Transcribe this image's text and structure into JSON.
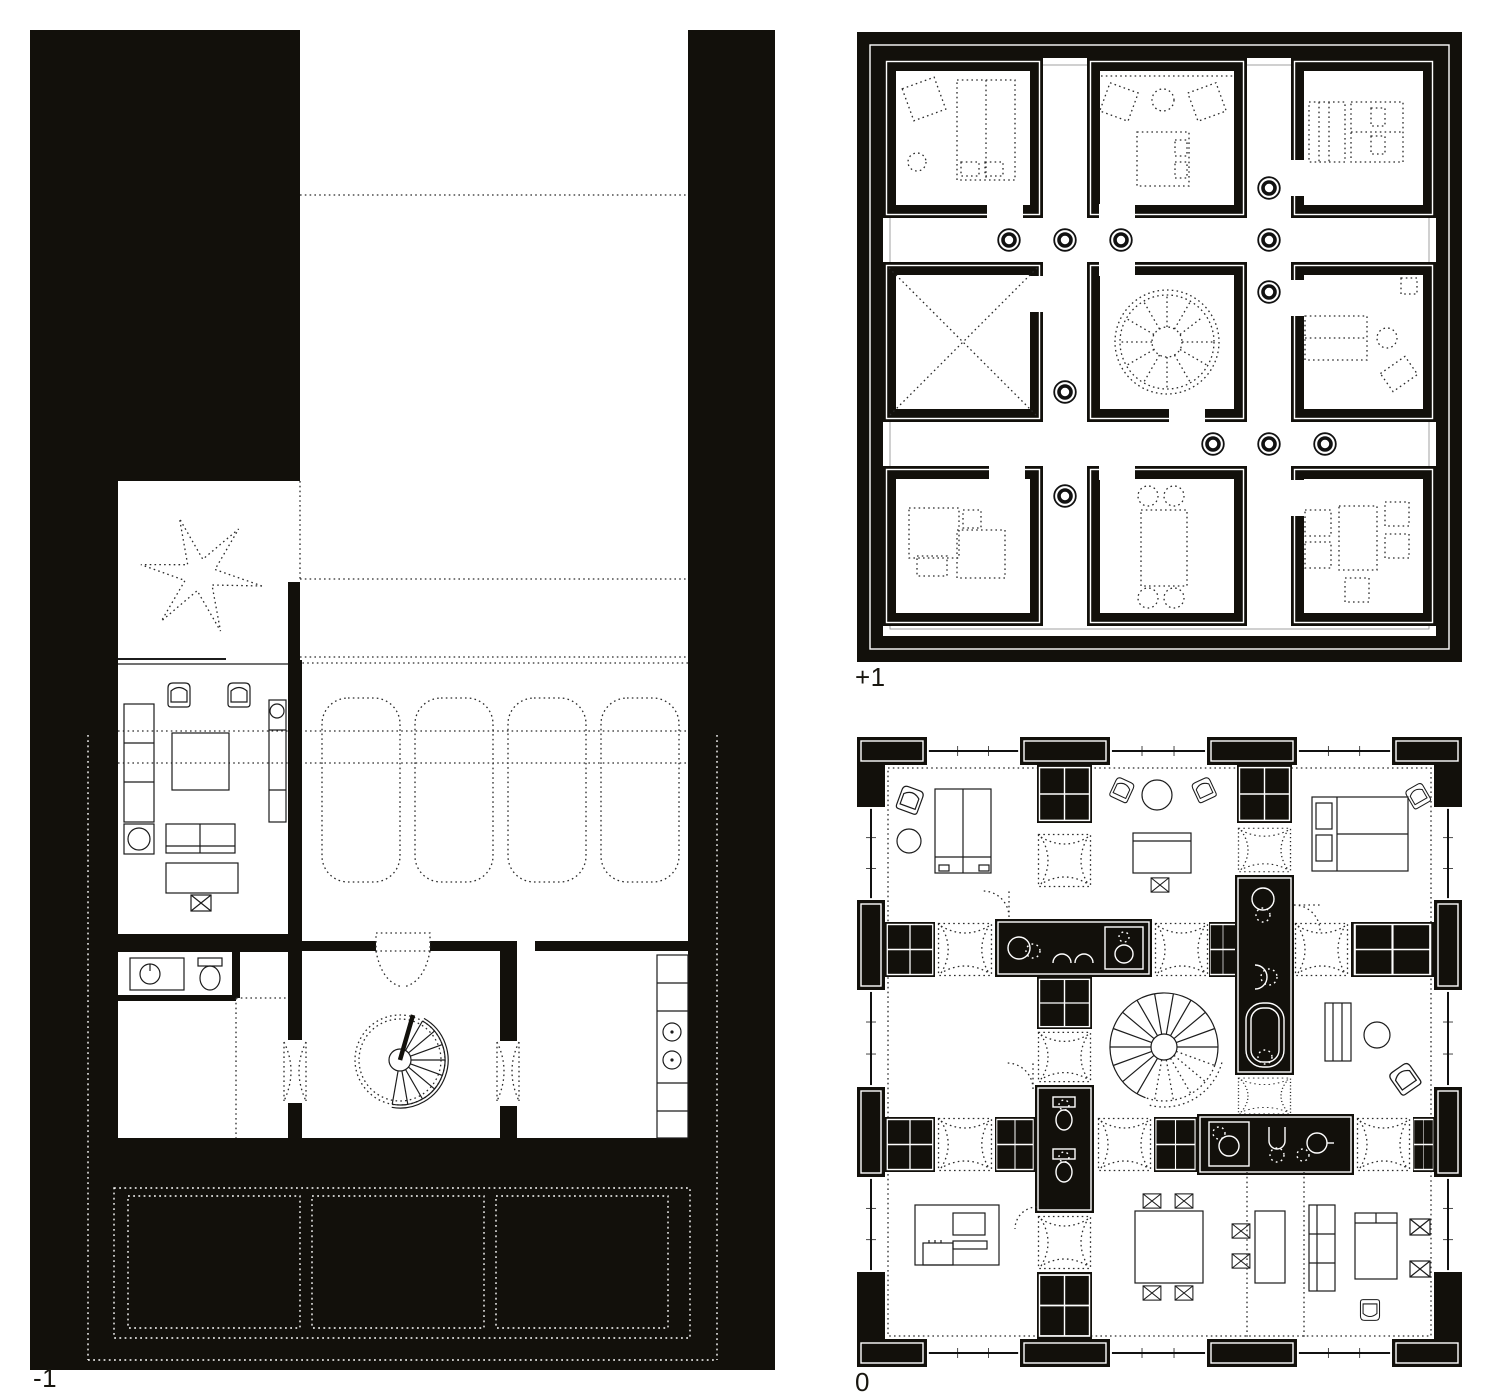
{
  "page": {
    "background": "#ffffff"
  },
  "colors": {
    "ink": "#12100b",
    "line": "#1c1c1c",
    "paper": "#ffffff"
  },
  "plans": {
    "basement": {
      "label": "-1"
    },
    "upper": {
      "label": "+1"
    },
    "ground": {
      "label": "0"
    }
  }
}
